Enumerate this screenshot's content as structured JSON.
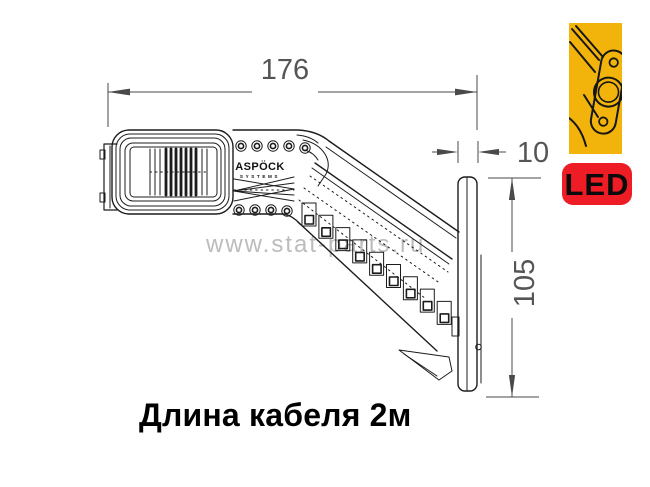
{
  "drawing": {
    "dim_width": "176",
    "dim_thickness": "10",
    "dim_height": "105",
    "brand": "ASPÖCK",
    "brand_sub": "SYSTEMS"
  },
  "watermark": "www.stat-parts.ru",
  "led_badge": "LED",
  "caption": "Длина кабеля 2м",
  "colors": {
    "led_badge_bg": "#ee1c25",
    "led_badge_fg": "#0a0a0a",
    "icon_bg": "#f2b40a",
    "drawing_line": "#1c1c1c",
    "dimension": "#4a4a4a",
    "watermark": "#bcbcbc"
  }
}
